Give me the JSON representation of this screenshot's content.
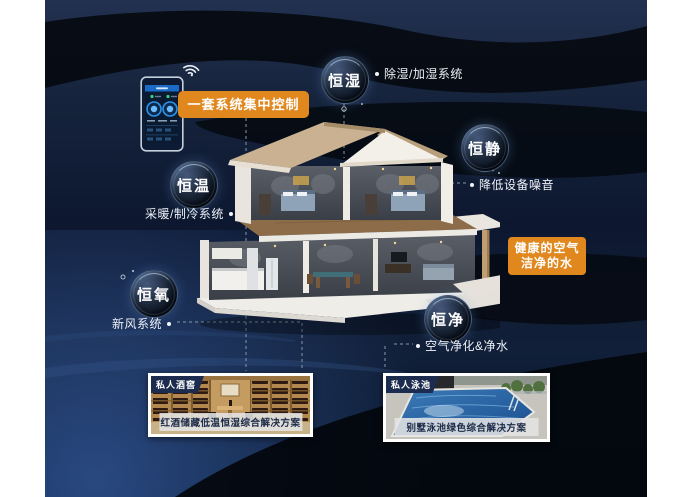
{
  "poster": {
    "control": {
      "label": "一套系统集中控制"
    },
    "bubbles": [
      {
        "id": "humidity",
        "label": "恒湿",
        "note": "除湿/加湿系统"
      },
      {
        "id": "quiet",
        "label": "恒静",
        "note": "降低设备噪音"
      },
      {
        "id": "temperature",
        "label": "恒温",
        "note": "采暖/制冷系统"
      },
      {
        "id": "oxygen",
        "label": "恒氧",
        "note": "新风系统"
      },
      {
        "id": "purity",
        "label": "恒净",
        "note": "空气净化&净水"
      }
    ],
    "highlight": {
      "line1": "健康的空气",
      "line2": "洁净的水"
    },
    "cards": [
      {
        "tag": "私人酒窖",
        "caption": "红酒储藏低温恒湿综合解决方案"
      },
      {
        "tag": "私人泳池",
        "caption": "别墅泳池绿色综合解决方案"
      }
    ],
    "colors": {
      "accent_orange": "#e0871d",
      "panel_navy": "#101d36",
      "wave_dark": "#05090f"
    },
    "icons": {
      "wifi": "wifi-icon",
      "control_panel": "smart-home-control-panel"
    }
  }
}
